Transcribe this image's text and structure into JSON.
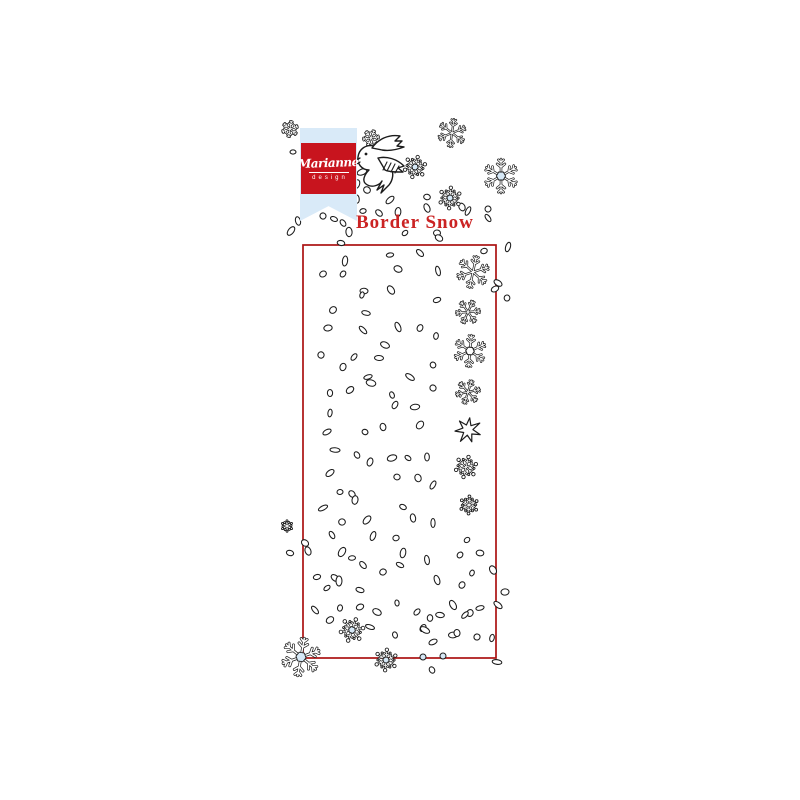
{
  "product": {
    "brand_name": "Marianne",
    "brand_subname": "design",
    "title": "Border Snow"
  },
  "colors": {
    "logo_red": "#c8141e",
    "ribbon_blue": "#d9eaf8",
    "title_red": "#cb2323",
    "border_red": "#ab1212",
    "flake_blue": "#d6e8f6",
    "ink": "#1c1c1c"
  },
  "stamp_area": {
    "x": 303,
    "y": 245,
    "width": 193,
    "height": 413
  },
  "scene": {
    "dots": [
      [
        293,
        152
      ],
      [
        343,
        223
      ],
      [
        357,
        184
      ],
      [
        362,
        172
      ],
      [
        367,
        190
      ],
      [
        357,
        199
      ],
      [
        390,
        200
      ],
      [
        427,
        197
      ],
      [
        462,
        207
      ],
      [
        468,
        211
      ],
      [
        363,
        211
      ],
      [
        379,
        213
      ],
      [
        398,
        212
      ],
      [
        323,
        216
      ],
      [
        334,
        219
      ],
      [
        298,
        221
      ],
      [
        291,
        231
      ],
      [
        437,
        233
      ],
      [
        488,
        218
      ],
      [
        508,
        247
      ],
      [
        484,
        251
      ],
      [
        439,
        238
      ],
      [
        349,
        232
      ],
      [
        405,
        233
      ],
      [
        341,
        243
      ],
      [
        427,
        208
      ],
      [
        488,
        209
      ],
      [
        390,
        255
      ],
      [
        420,
        253
      ],
      [
        345,
        261
      ],
      [
        323,
        274
      ],
      [
        398,
        269
      ],
      [
        438,
        271
      ],
      [
        343,
        274
      ],
      [
        364,
        291
      ],
      [
        391,
        290
      ],
      [
        362,
        295
      ],
      [
        437,
        300
      ],
      [
        498,
        283
      ],
      [
        507,
        298
      ],
      [
        333,
        310
      ],
      [
        366,
        313
      ],
      [
        398,
        327
      ],
      [
        420,
        328
      ],
      [
        328,
        328
      ],
      [
        363,
        330
      ],
      [
        436,
        336
      ],
      [
        495,
        289
      ],
      [
        385,
        345
      ],
      [
        321,
        355
      ],
      [
        354,
        357
      ],
      [
        379,
        358
      ],
      [
        433,
        365
      ],
      [
        343,
        367
      ],
      [
        368,
        377
      ],
      [
        410,
        377
      ],
      [
        330,
        393
      ],
      [
        350,
        390
      ],
      [
        371,
        383
      ],
      [
        392,
        395
      ],
      [
        395,
        405
      ],
      [
        415,
        407
      ],
      [
        433,
        388
      ],
      [
        330,
        413
      ],
      [
        327,
        432
      ],
      [
        365,
        432
      ],
      [
        383,
        427
      ],
      [
        420,
        425
      ],
      [
        335,
        450
      ],
      [
        357,
        455
      ],
      [
        370,
        462
      ],
      [
        392,
        458
      ],
      [
        408,
        458
      ],
      [
        427,
        457
      ],
      [
        330,
        473
      ],
      [
        397,
        477
      ],
      [
        418,
        478
      ],
      [
        433,
        485
      ],
      [
        340,
        492
      ],
      [
        352,
        494
      ],
      [
        355,
        500
      ],
      [
        323,
        508
      ],
      [
        403,
        507
      ],
      [
        413,
        518
      ],
      [
        367,
        520
      ],
      [
        342,
        522
      ],
      [
        332,
        535
      ],
      [
        373,
        536
      ],
      [
        396,
        538
      ],
      [
        305,
        543
      ],
      [
        433,
        523
      ],
      [
        467,
        540
      ],
      [
        290,
        553
      ],
      [
        308,
        551
      ],
      [
        342,
        552
      ],
      [
        352,
        558
      ],
      [
        363,
        565
      ],
      [
        403,
        553
      ],
      [
        383,
        572
      ],
      [
        400,
        565
      ],
      [
        427,
        560
      ],
      [
        460,
        555
      ],
      [
        480,
        553
      ],
      [
        493,
        570
      ],
      [
        472,
        573
      ],
      [
        317,
        577
      ],
      [
        335,
        578
      ],
      [
        339,
        581
      ],
      [
        327,
        588
      ],
      [
        360,
        590
      ],
      [
        437,
        580
      ],
      [
        462,
        585
      ],
      [
        505,
        592
      ],
      [
        315,
        610
      ],
      [
        340,
        608
      ],
      [
        360,
        607
      ],
      [
        377,
        612
      ],
      [
        397,
        603
      ],
      [
        417,
        612
      ],
      [
        440,
        615
      ],
      [
        453,
        605
      ],
      [
        470,
        613
      ],
      [
        480,
        608
      ],
      [
        498,
        605
      ],
      [
        430,
        618
      ],
      [
        330,
        620
      ],
      [
        370,
        627
      ],
      [
        395,
        635
      ],
      [
        423,
        628
      ],
      [
        453,
        635
      ],
      [
        477,
        637
      ],
      [
        492,
        638
      ],
      [
        433,
        642
      ],
      [
        425,
        630
      ],
      [
        457,
        633
      ],
      [
        465,
        615
      ],
      [
        497,
        662
      ],
      [
        432,
        670
      ]
    ],
    "blue_dots": [
      [
        423,
        657
      ],
      [
        443,
        656
      ]
    ],
    "snowflakes": [
      {
        "x": 290,
        "y": 129,
        "r": 8,
        "type": "dendrite",
        "center": "none",
        "rot": 10
      },
      {
        "x": 371,
        "y": 138,
        "r": 8,
        "type": "dendrite",
        "center": "none",
        "rot": 22
      },
      {
        "x": 452,
        "y": 133,
        "r": 14,
        "type": "dendrite",
        "center": "none",
        "rot": 8
      },
      {
        "x": 501,
        "y": 176,
        "r": 17,
        "type": "dendrite",
        "center": "blue",
        "rot": 0
      },
      {
        "x": 415,
        "y": 167,
        "r": 12,
        "type": "dotted",
        "center": "blue",
        "rot": 15
      },
      {
        "x": 450,
        "y": 198,
        "r": 12,
        "type": "dotted",
        "center": "blue",
        "rot": 5
      },
      {
        "x": 473,
        "y": 272,
        "r": 16,
        "type": "dendrite",
        "center": "none",
        "rot": 12
      },
      {
        "x": 468,
        "y": 312,
        "r": 12,
        "type": "dendrite",
        "center": "none",
        "rot": 25
      },
      {
        "x": 470,
        "y": 351,
        "r": 16,
        "type": "dendrite",
        "center": "hex",
        "rot": 5
      },
      {
        "x": 468,
        "y": 392,
        "r": 12,
        "type": "dendrite",
        "center": "none",
        "rot": 18
      },
      {
        "x": 468,
        "y": 430,
        "r": 13,
        "type": "star",
        "center": "none",
        "rot": 8
      },
      {
        "x": 466,
        "y": 467,
        "r": 12,
        "type": "dotted",
        "center": "none",
        "rot": 14
      },
      {
        "x": 469,
        "y": 505,
        "r": 10,
        "type": "dotted",
        "center": "none",
        "rot": 3
      },
      {
        "x": 301,
        "y": 657,
        "r": 19,
        "type": "dendrite",
        "center": "blue",
        "rot": 10
      },
      {
        "x": 352,
        "y": 630,
        "r": 13,
        "type": "dotted",
        "center": "blue",
        "rot": 20
      },
      {
        "x": 386,
        "y": 660,
        "r": 12,
        "type": "dotted",
        "center": "blue",
        "rot": 5
      },
      {
        "x": 287,
        "y": 526,
        "r": 6,
        "type": "dotted",
        "center": "none",
        "rot": 0
      }
    ],
    "bird": {
      "x": 383,
      "y": 165,
      "label": "bird-sketch"
    }
  }
}
